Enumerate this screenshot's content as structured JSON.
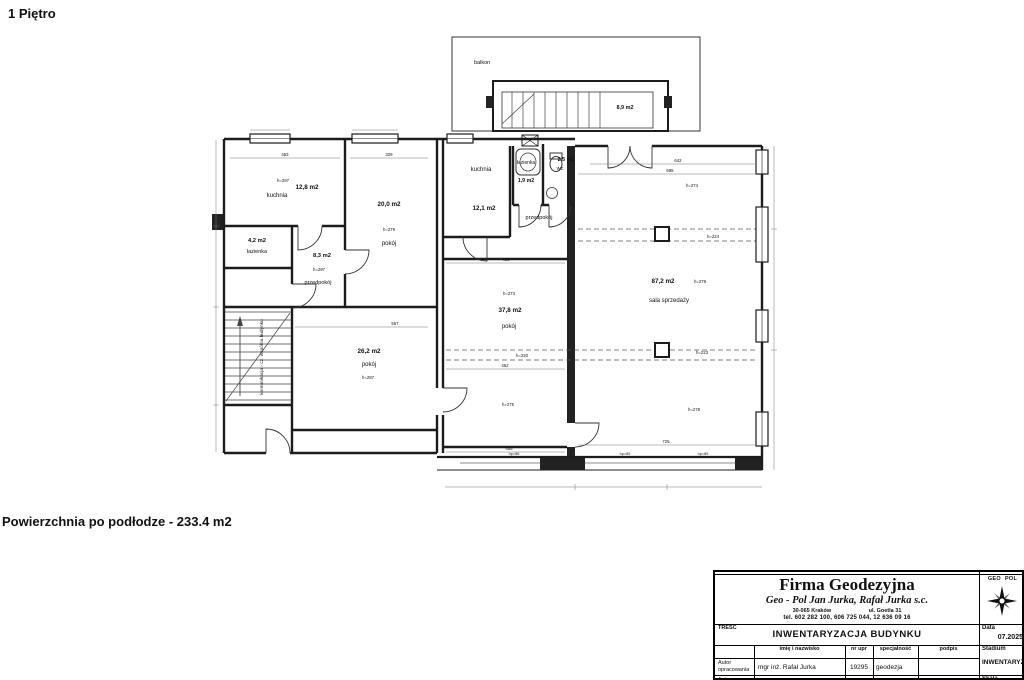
{
  "page": {
    "floor_title": "1 Piętro",
    "area_note": "Powierzchnia po podłodze - 233.4 m2"
  },
  "plan": {
    "labels": {
      "kuchnia1_h": "h=297",
      "kuchnia1_area": "12,8 m2",
      "kuchnia1_name": "kuchnia",
      "pokoj20_area": "20,0 m2",
      "pokoj20_h": "h=279",
      "pokoj20_name": "pokój",
      "lazienka1_area": "4,2 m2",
      "lazienka1_name": "łazienka",
      "przedpokoj1_area": "8,3 m2",
      "przedpokoj1_h": "h=297",
      "przedpokoj1_name": "przedpokój",
      "pokoj26_area": "26,2 m2",
      "pokoj26_name": "pokój",
      "pokoj26_h": "h=287",
      "kuchnia2_name": "kuchnia",
      "kuchnia2_area": "12,1 m2",
      "lazienka2_name": "łazienka",
      "lazienka2_area": "1,9 m2",
      "wc_area": "2,5 m2",
      "wc_name": "wc",
      "przedpokoj2_name": "przedpokój",
      "pokoj37_h_top": "h=273",
      "pokoj37_area": "37,8 m2",
      "pokoj37_name": "pokój",
      "pokoj37_h_mid": "h=220",
      "pokoj37_h_bottom": "h=275",
      "sala_h_top": "h=274",
      "sala_h_band1": "h=224",
      "sala_area": "87,2 m2",
      "sala_h_mid": "h=278",
      "sala_name": "sala sprzedaży",
      "sala_h_band2": "h=223",
      "sala_h_bottom": "h=278",
      "balkon_name": "balkon",
      "balkon_area": "8,9 m2",
      "stairs_label": "komunikacja - cz. wspólna budynku"
    },
    "dims": {
      "d453": "453",
      "d329": "329",
      "d567": "567",
      "d458": "458",
      "d452": "452",
      "d642": "642",
      "d695": "695",
      "d725": "725",
      "d455": "455",
      "hp1": "hp=86",
      "hp2": "hp=85",
      "hp3": "hp=85"
    }
  },
  "titleblock": {
    "company": "Firma Geodezyjna",
    "partners": "Geo - Pol Jan Jurka, Rafał Jurka s.c.",
    "address_city": "30-065 Kraków",
    "address_street": "ul. Goetla 31",
    "phone": "tel. 602 282 100, 606 725 044, 12 636 09 16",
    "logo_left": "GEO",
    "logo_right": "POL",
    "tresc_label": "TREŚĆ",
    "content_title": "INWENTARYZACJA BUDYNKU",
    "data_label": "Data",
    "data_value": "07.2025",
    "col_name": "imię i nazwisko",
    "col_nr": "nr upr",
    "col_spec": "specjalność",
    "col_podpis": "podpis",
    "stadium_label": "Stadium",
    "stadium_value": "INWENTARYZACJA",
    "row1_role": "Autor opracowania",
    "row1_name": "mgr inż. Rafał Jurka",
    "row1_nr": "19295",
    "row1_spec": "geodezja",
    "row2_role": "Autor",
    "skala_label": "Skala"
  }
}
